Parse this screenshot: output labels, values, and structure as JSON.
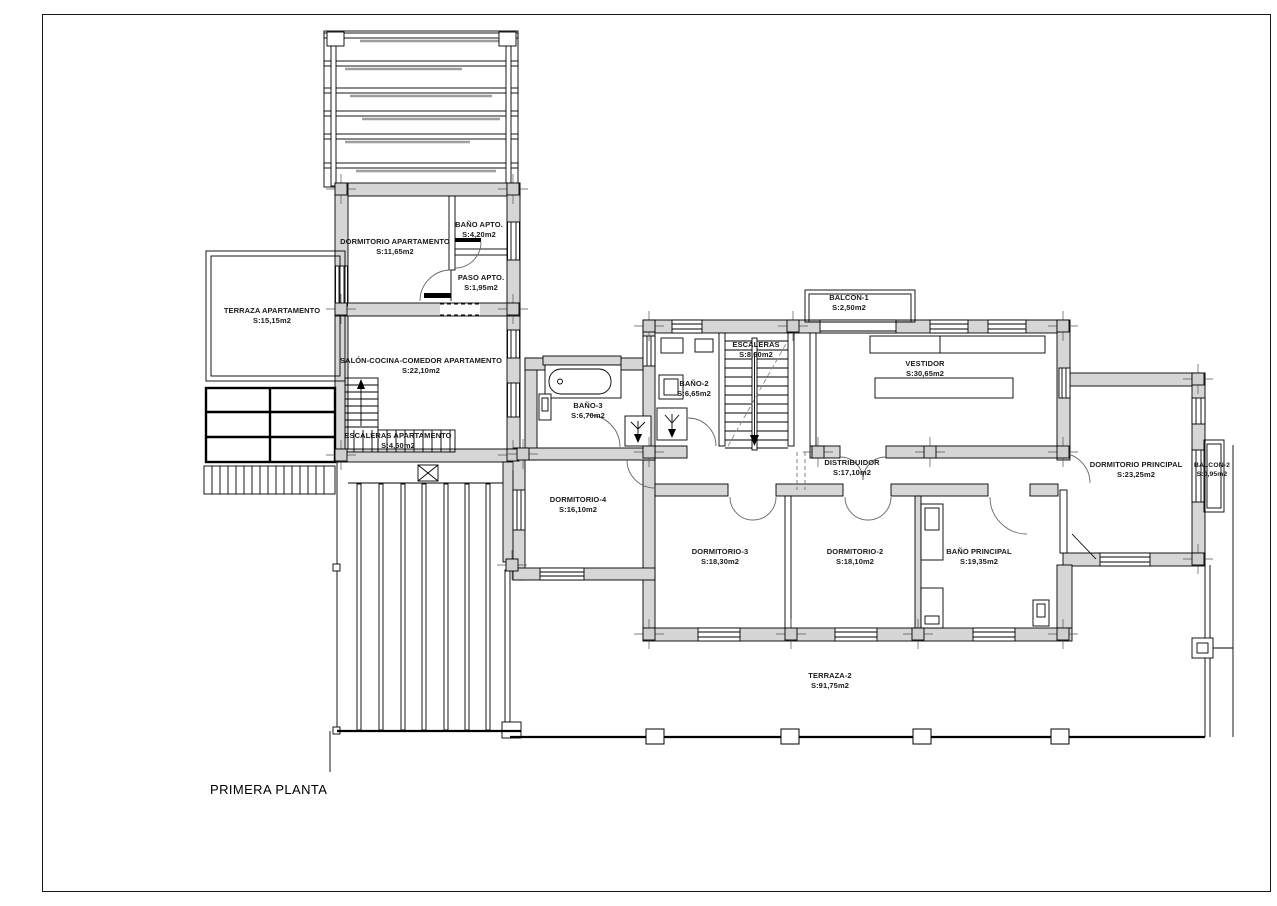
{
  "drawing": {
    "title": "PRIMERA PLANTA",
    "type": "architectural floor plan"
  },
  "colors": {
    "wall_fill": "#d6d6d6",
    "line": "#000000",
    "background": "#ffffff"
  },
  "rooms": [
    {
      "name": "DORMITORIO APARTAMENTO",
      "area": "S:11,65m2"
    },
    {
      "name": "BAÑO APTO.",
      "area": "S:4,20m2"
    },
    {
      "name": "PASO APTO.",
      "area": "S:1,95m2"
    },
    {
      "name": "TERRAZA APARTAMENTO",
      "area": "S:15,15m2"
    },
    {
      "name": "SALÓN-COCINA-COMEDOR APARTAMENTO",
      "area": "S:22,10m2"
    },
    {
      "name": "ESCALERAS APARTAMENTO",
      "area": "S:4,50m2"
    },
    {
      "name": "BAÑO-3",
      "area": "S:6,70m2"
    },
    {
      "name": "BAÑO-2",
      "area": "S:6,65m2"
    },
    {
      "name": "ESCALERAS",
      "area": "S:8,60m2"
    },
    {
      "name": "BALCON-1",
      "area": "S:2,50m2"
    },
    {
      "name": "VESTIDOR",
      "area": "S:30,65m2"
    },
    {
      "name": "DISTRIBUIDOR",
      "area": "S:17,10m2"
    },
    {
      "name": "DORMITORIO-4",
      "area": "S:16,10m2"
    },
    {
      "name": "DORMITORIO-3",
      "area": "S:18,30m2"
    },
    {
      "name": "DORMITORIO-2",
      "area": "S:18,10m2"
    },
    {
      "name": "BAÑO PRINCIPAL",
      "area": "S:19,35m2"
    },
    {
      "name": "DORMITORIO PRINCIPAL",
      "area": "S:23,25m2"
    },
    {
      "name": "BALCON-2",
      "area": "S:0,95m2"
    },
    {
      "name": "TERRAZA-2",
      "area": "S:91,75m2"
    }
  ]
}
